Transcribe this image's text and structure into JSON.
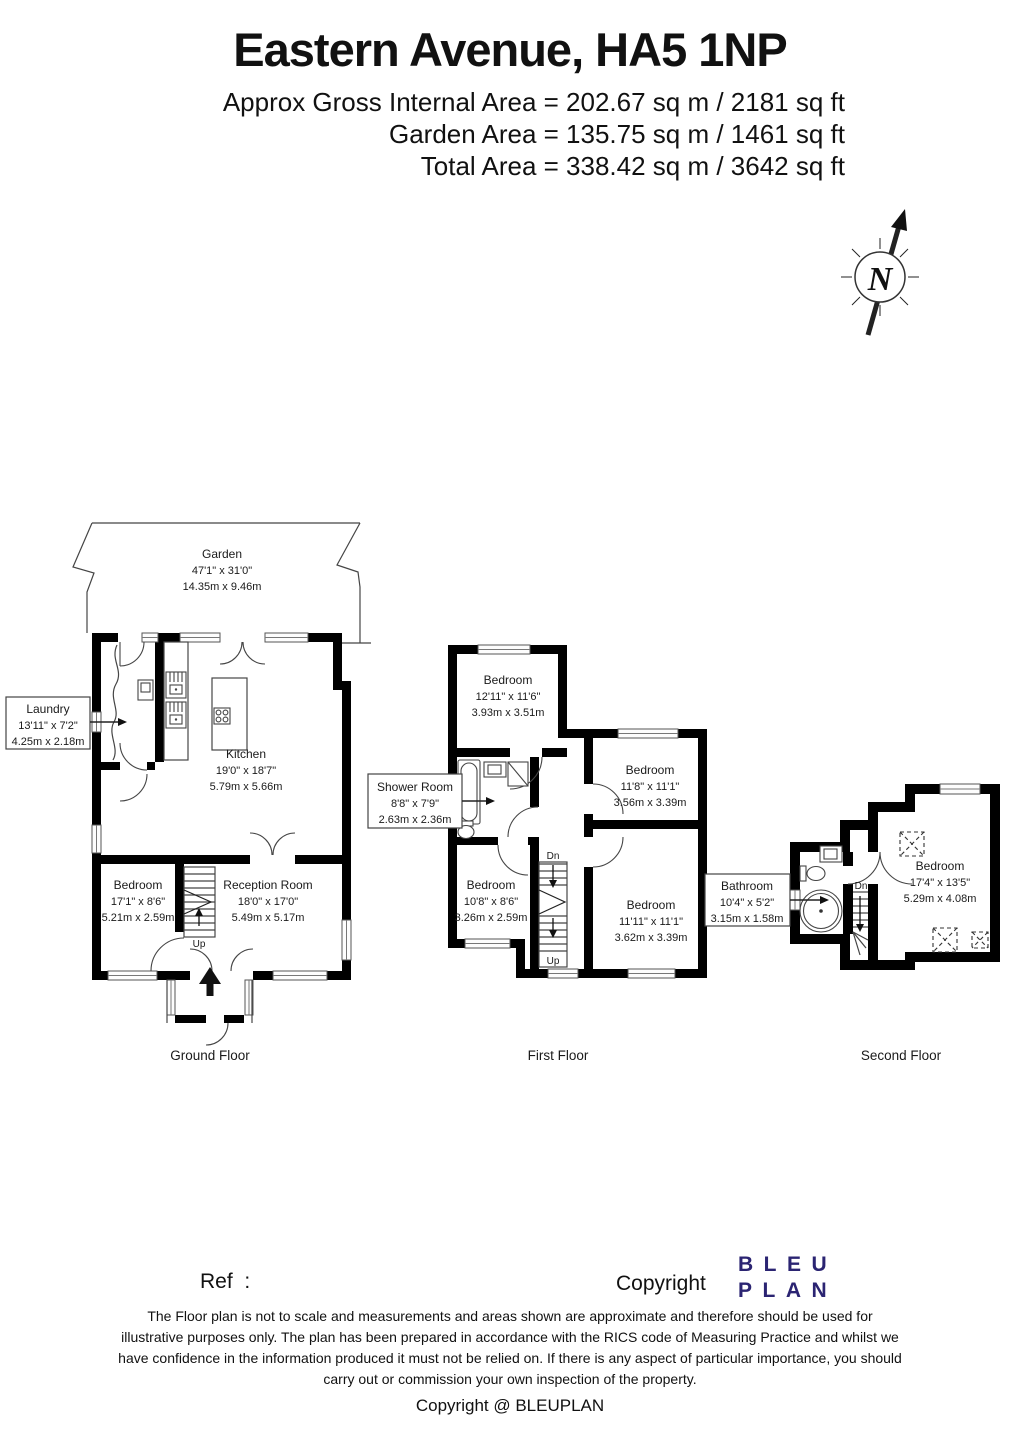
{
  "header": {
    "title": "Eastern Avenue, HA5 1NP",
    "area_lines": [
      "Approx Gross Internal Area = 202.67 sq m / 2181 sq ft",
      "Garden Area = 135.75 sq m / 1461 sq ft",
      "Total Area = 338.42 sq m / 3642 sq ft"
    ]
  },
  "north": {
    "label": "N"
  },
  "floors": {
    "ground": {
      "caption": "Ground Floor",
      "garden": {
        "name": "Garden",
        "imperial": "47'1\" x 31'0\"",
        "metric": "14.35m x 9.46m"
      },
      "kitchen": {
        "name": "Kitchen",
        "imperial": "19'0\" x 18'7\"",
        "metric": "5.79m x 5.66m"
      },
      "laundry": {
        "name": "Laundry",
        "imperial": "13'11\" x 7'2\"",
        "metric": "4.25m x 2.18m"
      },
      "bedroom": {
        "name": "Bedroom",
        "imperial": "17'1\" x 8'6\"",
        "metric": "5.21m x 2.59m"
      },
      "reception": {
        "name": "Reception Room",
        "imperial": "18'0\" x 17'0\"",
        "metric": "5.49m x 5.17m"
      },
      "up_label": "Up"
    },
    "first": {
      "caption": "First Floor",
      "bedroom_front": {
        "name": "Bedroom",
        "imperial": "12'11\" x 11'6\"",
        "metric": "3.93m x 3.51m"
      },
      "bedroom_right_top": {
        "name": "Bedroom",
        "imperial": "11'8\" x 11'1\"",
        "metric": "3.56m x 3.39m"
      },
      "bedroom_left_bottom": {
        "name": "Bedroom",
        "imperial": "10'8\" x 8'6\"",
        "metric": "3.26m x 2.59m"
      },
      "bedroom_right_bottom": {
        "name": "Bedroom",
        "imperial": "11'11\" x 11'1\"",
        "metric": "3.62m x 3.39m"
      },
      "shower_room": {
        "name": "Shower Room",
        "imperial": "8'8\" x 7'9\"",
        "metric": "2.63m x 2.36m"
      },
      "dn_label": "Dn",
      "up_label": "Up"
    },
    "second": {
      "caption": "Second Floor",
      "bedroom": {
        "name": "Bedroom",
        "imperial": "17'4\" x 13'5\"",
        "metric": "5.29m x 4.08m"
      },
      "bathroom": {
        "name": "Bathroom",
        "imperial": "10'4\" x 5'2\"",
        "metric": "3.15m x 1.58m"
      },
      "dn_label": "Dn"
    }
  },
  "footer": {
    "ref_label": "Ref  :",
    "copyright_label": "Copyright",
    "logo": {
      "line1": "BLEU",
      "line2": "PLAN",
      "color": "#2b2472"
    },
    "disclaimer_lines": [
      "The Floor plan is not to scale and measurements and areas shown are approximate and therefore should be used for",
      "illustrative purposes only. The plan has been prepared in accordance with the RICS code of Measuring Practice and whilst we",
      "have confidence in the information produced it must not be relied on. If there is any aspect of particular importance, you should",
      "carry out or commission your own inspection of the property."
    ],
    "copyright_line": "Copyright @ BLEUPLAN"
  },
  "colors": {
    "walls": "#000000",
    "thin_lines": "#454545",
    "text": "#1a1a1a",
    "logo": "#2b2472"
  }
}
